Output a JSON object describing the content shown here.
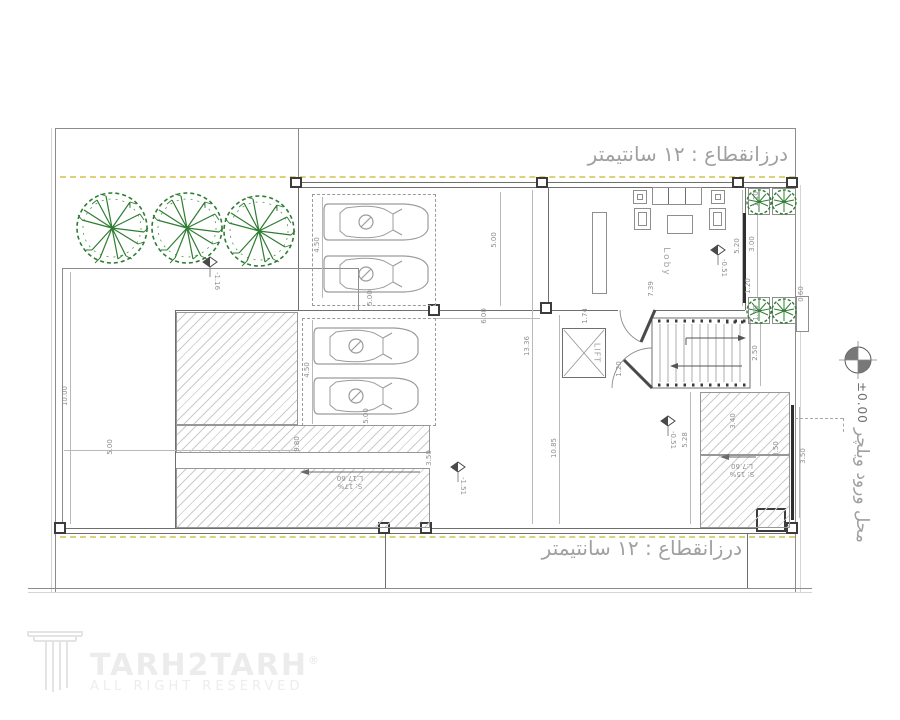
{
  "notes": {
    "joint_top": "درزانقطاع : ۱۲ سانتیمتر",
    "joint_bottom": "درزانقطاع : ۱۲ سانتیمتر",
    "wheelchair": "محل ورود ویلچر"
  },
  "rooms": {
    "lobby": "Loby",
    "lift": "LIFT"
  },
  "levels": {
    "entrance": "±0.00",
    "yard": "-1.16",
    "lobby": "-0.51",
    "ramp_mid": "-0.51",
    "parking": "-1.51"
  },
  "ramps": {
    "main": {
      "slope": "S: 17%",
      "length": "L:17.60"
    },
    "entry": {
      "slope": "S: 15%",
      "length": "L:7.60"
    }
  },
  "dimensions": {
    "d10_00": "10.00",
    "d5_00": "5.00",
    "d4_50": "4.50",
    "d6_00": "6.00",
    "d13_36": "13.36",
    "d10_85": "10.85",
    "d7_39": "7.39",
    "d5_20": "5.20",
    "d3_00": "3.00",
    "d1_20": "1.20",
    "d0_60": "0.60",
    "d1_10": "1.10",
    "d1_74": "1.74",
    "d2_50": "2.50",
    "d3_40": "3.40",
    "d3_50": "3.50",
    "d5_28": "5.28",
    "d9_80": "9.80"
  },
  "logo": {
    "name": "TARH2TARH",
    "reg": "®",
    "tagline": "ALL RIGHT RESERVED"
  }
}
